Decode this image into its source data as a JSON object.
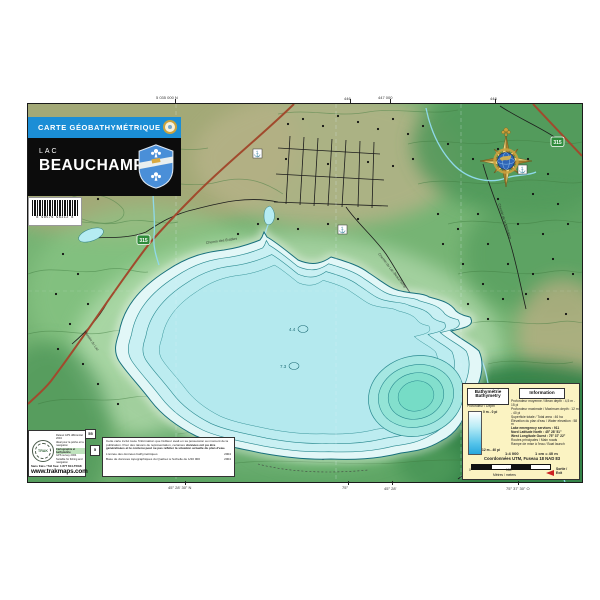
{
  "banner": {
    "label": "CARTE GÉOBATHYMÉTRIQUE"
  },
  "title_block": {
    "prefix": "LAC",
    "name": "BEAUCHAMP"
  },
  "barcode": {
    "digits": "8 98576 96312 8"
  },
  "colors": {
    "banner_blue": "#1b8ed6",
    "terrain_green": "#76b474",
    "lake_cyan": "#b7ecf0",
    "deep_teal": "#7edcc8",
    "route_red": "#a14a2d",
    "info_bg": "#fbf3c2"
  },
  "edge_labels": {
    "top": [
      "5 035 000 N",
      "446",
      "447 000",
      "448"
    ],
    "bottom": [
      "45° 28' 30\" N",
      "75°",
      "45° 28'",
      "75° 37' 30\" O"
    ]
  },
  "map": {
    "shield_a": "315",
    "shield_b": "315",
    "marker_55": "55",
    "marker_5": "5",
    "depth_1": "4.4",
    "depth_2": "7.3",
    "poi_glyph": "⚓",
    "road_labels": [
      "Chemin du Lac-Beauchamp",
      "Chemin de la Montagne",
      "Chemin des Érables",
      "Montée du Lac"
    ]
  },
  "trak_box": {
    "logo_text": "TRAK",
    "bullets": [
      "Relevé GPS différentiel 2004",
      "Idéal pour la pêche et la navigation",
      "Cartographie et bathymétrie",
      "GPS survey 2004",
      "Suitable for fishing and navigation"
    ],
    "tollfree": "Sans frais / Toll free: 1 877 814-TRAK",
    "website": "www.trakmaps.com"
  },
  "disclaimer_box": {
    "para1": "Cette carte inclut toute l'information que l'éditeur avait en sa possession au moment de la publication. Pour des raisons de représentation, certaines",
    "para_bold": "données ont pu être généralisées et le contenu peut ne pas refléter la situation actuelle du plan d'eau.",
    "row1_label": "L'année des données bathymétriques",
    "row1_value": "2004",
    "row2_label": "Base de données topographiques du Québec à l'échelle de 1/20 000",
    "row2_value": "2004"
  },
  "info_box": {
    "bathy_fr": "Bathymétrie",
    "bathy_en": "Bathymetry",
    "depth_label": "Profondeur / Depth",
    "depth_top": "0 m - 0 pi",
    "depth_bottom": "12 m - 40 pi",
    "information_title": "Information",
    "lines": [
      "Profondeur moyenne / Mean depth : 4,5 m - 15 pi",
      "Profondeur maximale / Maximum depth : 12 m - 40 pi",
      "Superficie totale / Total area : 46 ha",
      "Élévation du plan d'eau / Water elevation : 58 m",
      "Lake emergency services : 911",
      "Nord Latitude North : 45° 28' 51\"",
      "West Longitude Ouest : 75° 37' 22\"",
      "Routes principales / Main roads",
      "Rampe de mise à l'eau / Boat launch"
    ],
    "scale": "1:4 000",
    "scale_cm": "1 cm = 40 m",
    "coords": "Coordonnées UTM, Fuseau 18 NAD 83",
    "bar_zero": "0",
    "bar_mid": "100",
    "bar_units": "Mètres / meters",
    "exit_line1": "Sortie /",
    "exit_line2": "Exit"
  }
}
